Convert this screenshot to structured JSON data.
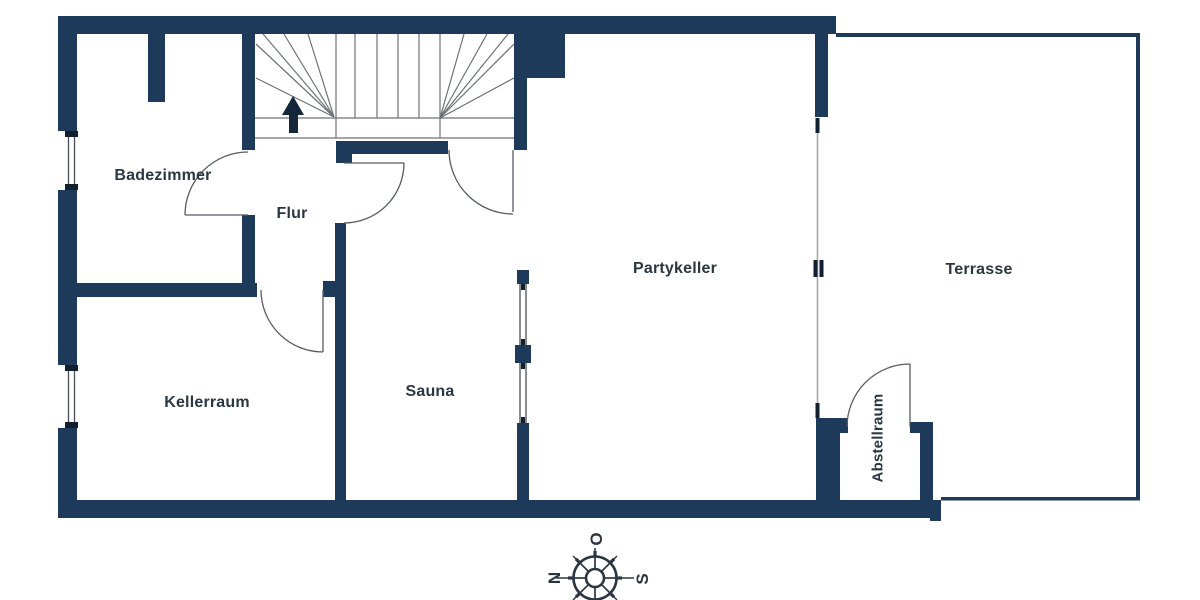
{
  "floorplan": {
    "title": "Kellergeschoss Grundriss",
    "rooms": [
      {
        "id": "badezimmer",
        "label": "Badezimmer"
      },
      {
        "id": "flur",
        "label": "Flur"
      },
      {
        "id": "kellerraum",
        "label": "Kellerraum"
      },
      {
        "id": "sauna",
        "label": "Sauna"
      },
      {
        "id": "partykeller",
        "label": "Partykeller"
      },
      {
        "id": "terrasse",
        "label": "Terrasse"
      },
      {
        "id": "abstellraum",
        "label": "Abstellraum"
      }
    ],
    "compass": {
      "top": "O",
      "left": "N",
      "right": "S"
    },
    "colors": {
      "wall": "#1e3a5a",
      "wall_dark_cap": "#10202e",
      "stair_line": "#6d7175",
      "door_line": "#565b61",
      "terrace_line": "#a8a8a8",
      "text": "#2b3642"
    }
  }
}
